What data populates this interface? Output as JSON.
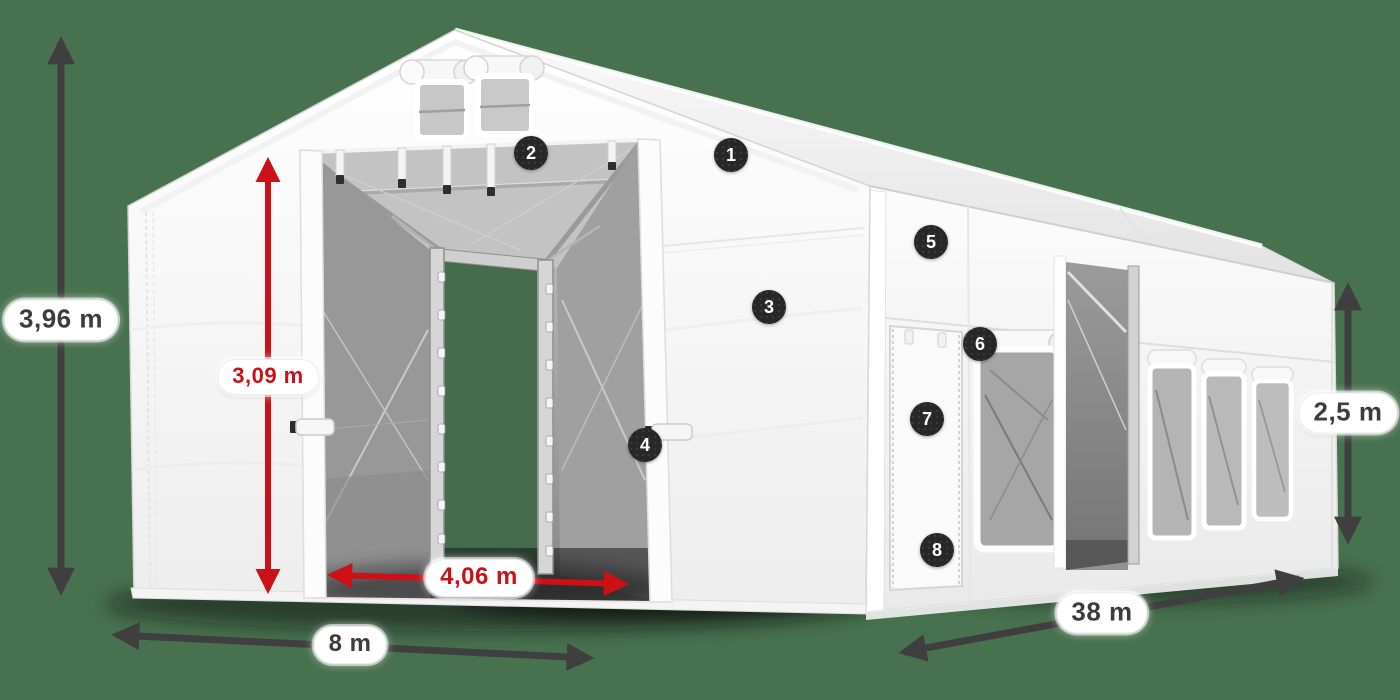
{
  "colors": {
    "background": "#48714f",
    "dimension_red": "#cc1017",
    "dimension_dark": "#3f3f3f",
    "callout_background": "#272727",
    "callout_number": "#ffffff",
    "label_background": "#ffffff",
    "label_text": "#3c3c3c",
    "tent_fabric": "#f8f8f8",
    "interior_mesh": "#9c9c9c"
  },
  "measurements": [
    {
      "id": "total-height",
      "value": "3,96 m",
      "style": "dark",
      "orientation": "vertical"
    },
    {
      "id": "entrance-height",
      "value": "3,09 m",
      "style": "red",
      "orientation": "vertical"
    },
    {
      "id": "entrance-width",
      "value": "4,06 m",
      "style": "red",
      "orientation": "horizontal"
    },
    {
      "id": "front-width",
      "value": "8 m",
      "style": "dark",
      "orientation": "horizontal"
    },
    {
      "id": "side-length",
      "value": "38 m",
      "style": "dark",
      "orientation": "diagonal"
    },
    {
      "id": "side-wall-height",
      "value": "2,5 m",
      "style": "dark",
      "orientation": "vertical"
    }
  ],
  "callouts": [
    {
      "number": "1"
    },
    {
      "number": "2"
    },
    {
      "number": "3"
    },
    {
      "number": "4"
    },
    {
      "number": "5"
    },
    {
      "number": "6"
    },
    {
      "number": "7"
    },
    {
      "number": "8"
    }
  ]
}
